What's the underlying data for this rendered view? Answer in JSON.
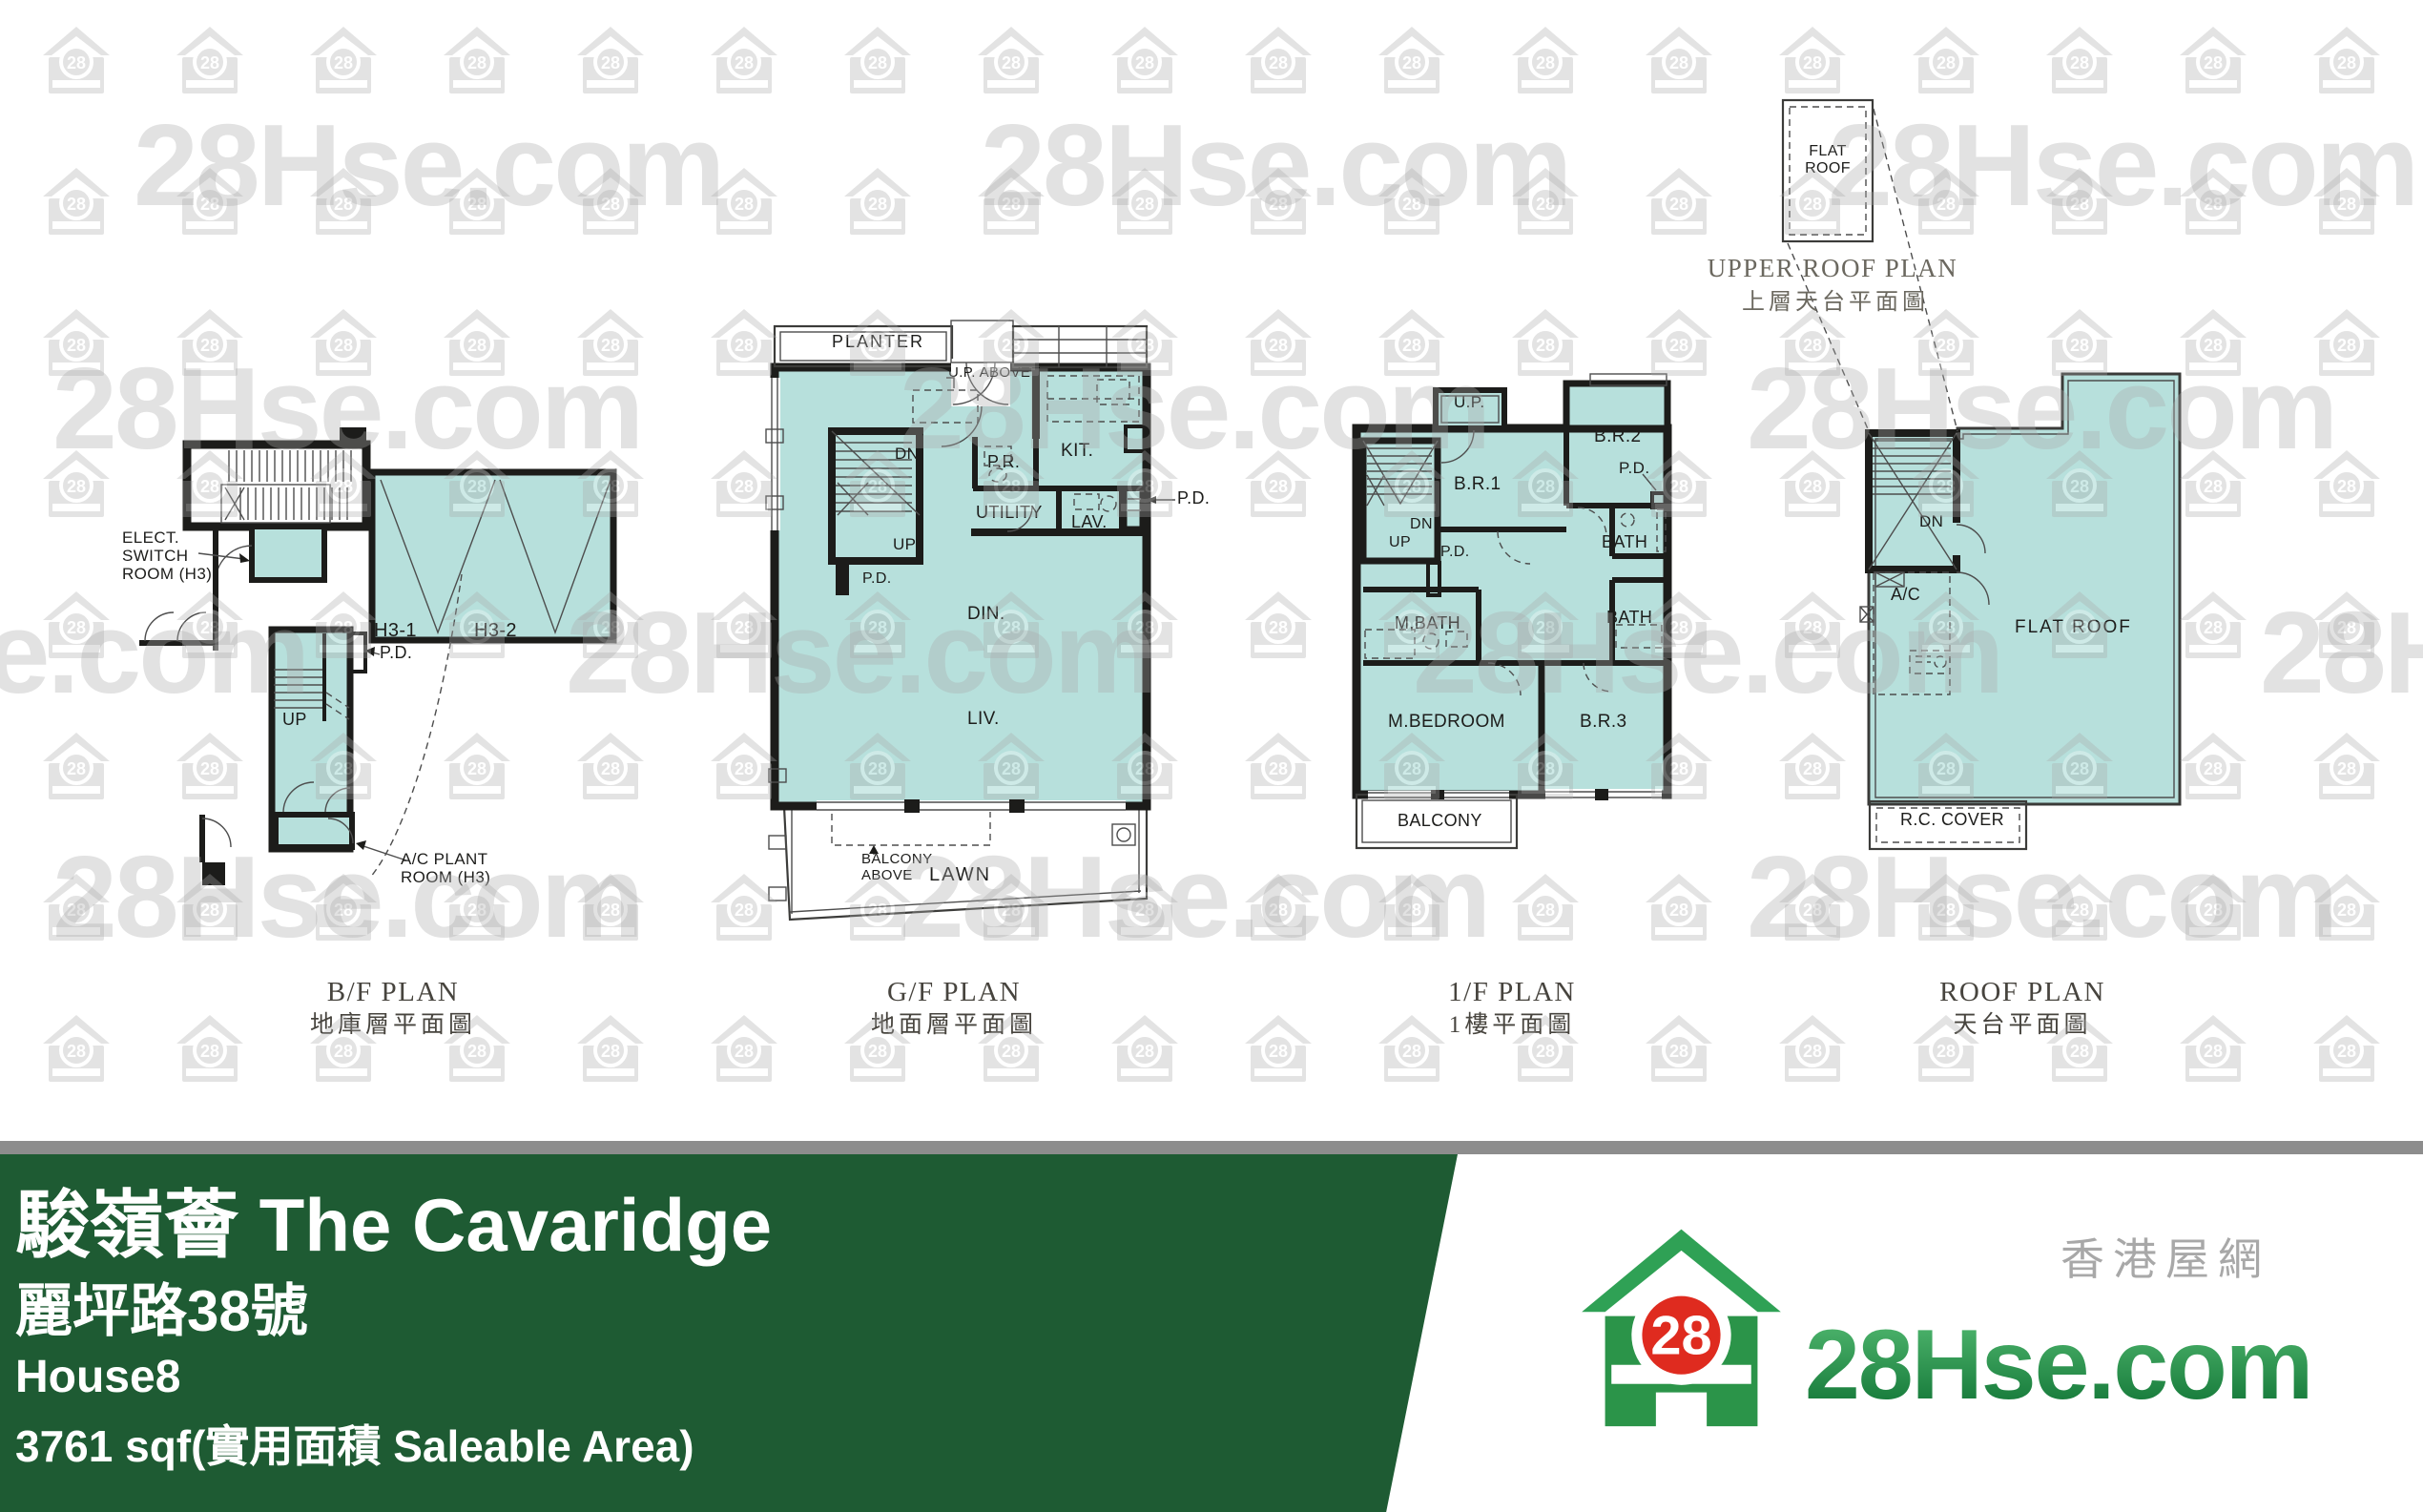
{
  "watermark": {
    "text": "28Hse.com",
    "badge": "28"
  },
  "plans": {
    "bf": {
      "title_en": "B/F PLAN",
      "title_zh": "地庫層平面圖",
      "labels": {
        "elect": "ELECT.\nSWITCH\nROOM (H3)",
        "h31": "H3-1",
        "h32": "H3-2",
        "pd": "P.D.",
        "up": "UP",
        "ac": "A/C PLANT\nROOM (H3)"
      }
    },
    "gf": {
      "title_en": "G/F PLAN",
      "title_zh": "地面層平面圖",
      "labels": {
        "planter": "PLANTER",
        "up_above": "U.P. ABOVE",
        "dn": "DN",
        "up": "UP",
        "pd_stair": "P.D.",
        "pr": "P.R.",
        "kit": "KIT.",
        "utility": "UTILITY",
        "lav": "LAV.",
        "pd_right": "P.D.",
        "din": "DIN.",
        "liv": "LIV.",
        "balcony_above": "BALCONY\nABOVE",
        "lawn": "LAWN"
      }
    },
    "ff": {
      "title_en": "1/F PLAN",
      "title_zh": "1樓平面圖",
      "labels": {
        "up_porch": "U.P.",
        "br1": "B.R.1",
        "br2": "B.R.2",
        "pd1": "P.D.",
        "dn": "DN",
        "up": "UP",
        "pd2": "P.D.",
        "bath1": "BATH",
        "bath2": "BATH",
        "mbath": "M.BATH",
        "mbedroom": "M.BEDROOM",
        "br3": "B.R.3",
        "balcony": "BALCONY"
      }
    },
    "roof": {
      "title_en": "ROOF PLAN",
      "title_zh": "天台平面圖",
      "labels": {
        "dn": "DN",
        "ac": "A/C",
        "flat_roof": "FLAT ROOF",
        "rc_cover": "R.C. COVER"
      }
    },
    "upper": {
      "title_en": "UPPER ROOF PLAN",
      "title_zh": "上層天台平面圖",
      "labels": {
        "flat_roof": "FLAT\nROOF"
      }
    }
  },
  "banner": {
    "title": "駿嶺薈 The Cavaridge",
    "address": "麗坪路38號",
    "house": "House8",
    "area": "3761 sqf(實用面積 Saleable Area)",
    "bg": "#1e5b33",
    "divider": "#8d8d8d"
  },
  "logo": {
    "brand": "28Hse.com",
    "site_zh": "香港屋網",
    "badge": "28"
  }
}
